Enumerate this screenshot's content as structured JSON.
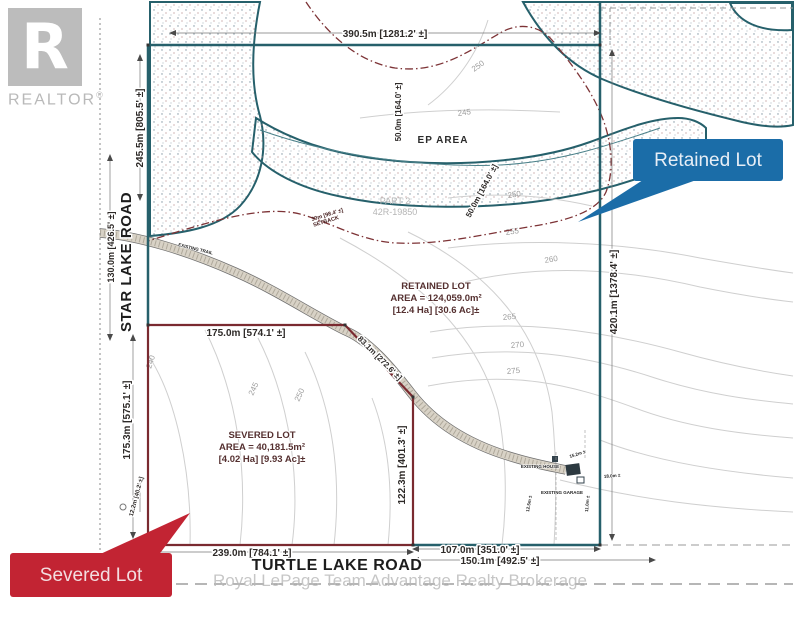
{
  "branding": {
    "realtor_logo_letter": "R",
    "realtor_word": "REALTOR",
    "registered_mark": "®",
    "watermark": "Royal LePage Team Advantage Realty Brokerage"
  },
  "callouts": {
    "retained": {
      "label": "Retained Lot",
      "color": "#1b6da8"
    },
    "severed": {
      "label": "Severed Lot",
      "color": "#c22433"
    }
  },
  "roads": {
    "west": "STAR LAKE ROAD",
    "south": "TURTLE LAKE ROAD"
  },
  "lots": {
    "retained": {
      "line1": "RETAINED LOT",
      "line2": "AREA = 124,059.0m²",
      "line3": "[12.4 Ha] [30.6 Ac]±"
    },
    "severed": {
      "line1": "SEVERED LOT",
      "line2": "AREA = 40,181.5m²",
      "line3": "[4.02 Ha] [9.93 Ac]±"
    }
  },
  "dimensions": {
    "top": "390.5m [1281.2' ±]",
    "west_retained": "245.5m [805.5' ±]",
    "west_road": "130.0m [426.5' ±]",
    "west_severed": "175.3m [575.1' ±]",
    "east": "420.1m [1378.4' ±]",
    "split_north": "175.0m [574.1' ±]",
    "split_diag": "83.1m [272.6' ±]",
    "split_east": "122.3m [401.3' ±]",
    "south_severed": "239.0m [784.1' ±]",
    "south_retained": "107.0m [351.0' ±]",
    "south_total": "150.1m [492.5' ±]",
    "corner_jog": "12.2m [40.2' ±]",
    "setback_offset_a": "50.0m [164.0' ±]",
    "setback_offset_b": "50.0m [164.0' ±]",
    "setback_line1": "30m [98.4' ±]",
    "setback_line2": "SETBACK"
  },
  "map_labels": {
    "ep_area": "EP AREA",
    "part": "PART 2",
    "plan": "42R-19850",
    "trail": "EXISTING TRAIL",
    "house": "EXISTING HOUSE",
    "garage": "EXISTING GARAGE"
  },
  "small_dims": {
    "d1": "15.2m ±",
    "d2": "18.0m ±",
    "d3": "12.5m ±",
    "d4": "11.0m ±"
  },
  "contours": {
    "labels": [
      "240",
      "245",
      "250",
      "250",
      "245",
      "250",
      "255",
      "260",
      "265",
      "270",
      "275"
    ]
  },
  "colors": {
    "boundary_teal": "#26606b",
    "boundary_red": "#7a2a30",
    "setback_red": "#7d3336",
    "contour_gray": "#cfcfcf",
    "callout_blue": "#1b6da8",
    "callout_red": "#c22433"
  }
}
